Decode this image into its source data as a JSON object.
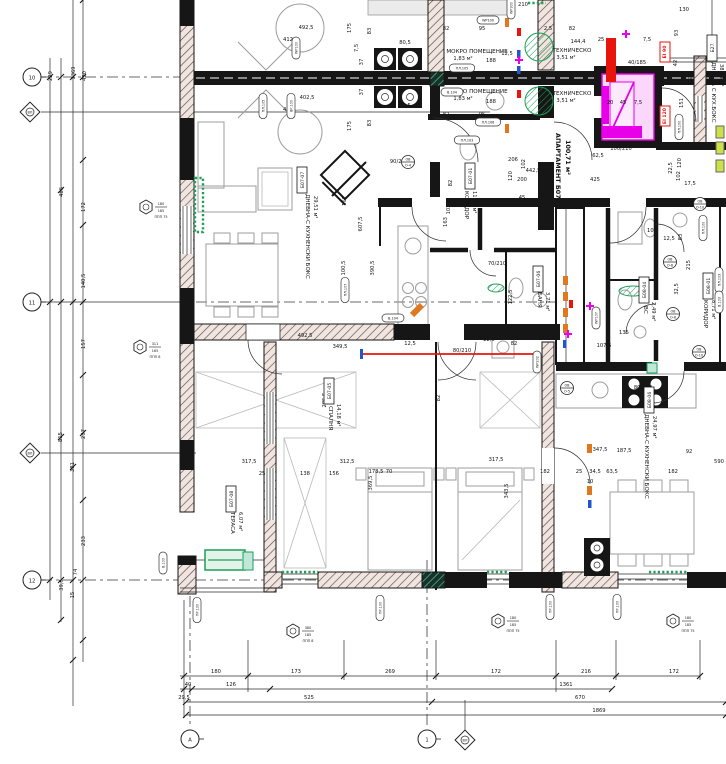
{
  "colors": {
    "wall": "#161616",
    "green": "#1d9e57",
    "teal_fill": "#bfe8d8",
    "magenta": "#e800e8",
    "pink": "#fbd7fb",
    "red": "#e8150d",
    "orange": "#e07820",
    "blue": "#2256cc",
    "wall_tint": "#f2e4de",
    "furniture": "#9d9d9d",
    "yellow_green": "#cde04a"
  },
  "rooms": [
    [
      "МОКРО ПОМЕЩЕНИЕ",
      477,
      53,
      0,
      "room"
    ],
    [
      "1,83 м²",
      463,
      60,
      0,
      "area"
    ],
    [
      "МОКРО ПОМЕЩЕНИЕ",
      477,
      93,
      0,
      "room"
    ],
    [
      "1,83 м²",
      463,
      100,
      0,
      "area"
    ],
    [
      "ТЕХНИЧЕСКО",
      572,
      52,
      0,
      "room"
    ],
    [
      "3,51 м²",
      566,
      59,
      0,
      "area"
    ],
    [
      "ТЕХНИЧЕСКО",
      572,
      95,
      0,
      "room"
    ],
    [
      "3,51 м²",
      566,
      102,
      0,
      "area"
    ],
    [
      "АПАРТАМЕНТ Б07",
      556,
      133,
      90,
      "apt"
    ],
    [
      "100,71 м²",
      566,
      140,
      90,
      "apt"
    ],
    [
      "ДНЕВНА-С КУХНЕНСКИ БОКС",
      306,
      194,
      90,
      "room"
    ],
    [
      "29,51 м²",
      314,
      196,
      90,
      "area"
    ],
    [
      "КОРИДОР",
      465,
      191,
      90,
      "room"
    ],
    [
      "11,93 м²",
      473,
      191,
      90,
      "area"
    ],
    [
      "БАНЯ",
      538,
      292,
      90,
      "room"
    ],
    [
      "3,71 м²",
      546,
      292,
      90,
      "area"
    ],
    [
      "ВС",
      644,
      306,
      90,
      "room"
    ],
    [
      "2,49 м²",
      652,
      302,
      90,
      "area"
    ],
    [
      "КОРИДОР",
      704,
      300,
      90,
      "room"
    ],
    [
      "8,71 м²",
      712,
      300,
      90,
      "area"
    ],
    [
      "СПАЛНЯ",
      329,
      406,
      90,
      "room"
    ],
    [
      "14,18 м²",
      337,
      404,
      90,
      "area"
    ],
    [
      "ТЕРАСА",
      231,
      512,
      90,
      "room"
    ],
    [
      "6,07 м²",
      239,
      512,
      90,
      "area"
    ],
    [
      "ДНЕВНА-С КУХНЕНСКИ БОКС",
      645,
      414,
      90,
      "room"
    ],
    [
      "24,97 м²",
      653,
      416,
      90,
      "area"
    ],
    [
      "ДНЕВНА С КУХ.БОКС",
      712,
      62,
      90,
      "room"
    ],
    [
      "38,73 м²",
      720,
      64,
      90,
      "area"
    ]
  ],
  "tagboxes": [
    [
      "Б07-07",
      302,
      180,
      -90
    ],
    [
      "Б07-01",
      470,
      176,
      -90
    ],
    [
      "Б07-05",
      329,
      391,
      -90
    ],
    [
      "Б07-06",
      538,
      279,
      -90
    ],
    [
      "Б07-08",
      231,
      499,
      -90
    ],
    [
      "Б08-01",
      708,
      286,
      -90
    ],
    [
      "Б08-04",
      644,
      290,
      -90
    ],
    [
      "Б08-06",
      649,
      400,
      -90
    ],
    [
      "Б27",
      712,
      48,
      -90
    ]
  ],
  "dims": [
    [
      "492,5",
      306,
      29,
      0
    ],
    [
      "412",
      288,
      41,
      0
    ],
    [
      "402,5",
      307,
      99,
      0
    ],
    [
      "412",
      288,
      111,
      0
    ],
    [
      "82",
      446,
      30,
      0
    ],
    [
      "95",
      482,
      30,
      0
    ],
    [
      "2,5",
      548,
      30,
      0
    ],
    [
      "82",
      572,
      30,
      0
    ],
    [
      "80,5",
      405,
      44,
      0
    ],
    [
      "188",
      491,
      62,
      0
    ],
    [
      "12,5",
      507,
      55,
      0
    ],
    [
      "144,4",
      578,
      43,
      0
    ],
    [
      "80,5",
      405,
      107,
      0
    ],
    [
      "188",
      491,
      103,
      0
    ],
    [
      "82",
      446,
      116,
      0
    ],
    [
      "95",
      482,
      116,
      0
    ],
    [
      "210",
      523,
      6,
      0
    ],
    [
      "130",
      684,
      11,
      0
    ],
    [
      "25",
      601,
      41,
      0
    ],
    [
      "7,5",
      647,
      41,
      0
    ],
    [
      "20",
      610,
      104,
      0
    ],
    [
      "45",
      623,
      104,
      0
    ],
    [
      "7,5",
      638,
      104,
      0
    ],
    [
      "93",
      678,
      33,
      -90
    ],
    [
      "42",
      677,
      63,
      -90
    ],
    [
      "296",
      692,
      78,
      -90
    ],
    [
      "151",
      683,
      103,
      -90
    ],
    [
      "120",
      681,
      163,
      -90
    ],
    [
      "102",
      680,
      176,
      -90
    ],
    [
      "17,5",
      690,
      185,
      0
    ],
    [
      "22,5",
      672,
      168,
      -90
    ],
    [
      "175",
      351,
      28,
      -90
    ],
    [
      "83",
      371,
      31,
      -90
    ],
    [
      "7,5",
      358,
      48,
      -90
    ],
    [
      "37",
      363,
      62,
      -90
    ],
    [
      "37",
      363,
      92,
      -90
    ],
    [
      "175",
      351,
      126,
      -90
    ],
    [
      "83",
      371,
      123,
      -90
    ],
    [
      "162",
      346,
      201,
      -90
    ],
    [
      "607,5",
      362,
      224,
      -90
    ],
    [
      "100,5",
      345,
      268,
      -90
    ],
    [
      "390,5",
      374,
      268,
      -90
    ],
    [
      "285,5",
      326,
      400,
      -90
    ],
    [
      "82",
      440,
      398,
      -90
    ],
    [
      "206",
      513,
      161,
      0
    ],
    [
      "102",
      525,
      164,
      -90
    ],
    [
      "442,5",
      533,
      172,
      0
    ],
    [
      "200",
      522,
      181,
      0
    ],
    [
      "120",
      512,
      176,
      -90
    ],
    [
      "45",
      522,
      199,
      0
    ],
    [
      "62,5",
      598,
      157,
      0
    ],
    [
      "425",
      595,
      181,
      0
    ],
    [
      "82",
      452,
      183,
      -90
    ],
    [
      "103,5",
      450,
      207,
      -90
    ],
    [
      "163",
      447,
      222,
      -90
    ],
    [
      "492,5",
      305,
      337,
      0
    ],
    [
      "349,5",
      340,
      348,
      0
    ],
    [
      "12,5",
      410,
      345,
      0
    ],
    [
      "82",
      514,
      345,
      0
    ],
    [
      "22,5",
      489,
      341,
      0
    ],
    [
      "122,5",
      512,
      297,
      -90
    ],
    [
      "135",
      624,
      334,
      0
    ],
    [
      "107,5",
      604,
      347,
      0
    ],
    [
      "37,5",
      622,
      366,
      0
    ],
    [
      "12,5",
      669,
      240,
      0
    ],
    [
      "102",
      652,
      232,
      0
    ],
    [
      "215",
      690,
      265,
      -90
    ],
    [
      "32,5",
      678,
      289,
      -90
    ],
    [
      "83",
      682,
      237,
      -90
    ],
    [
      "347,5",
      600,
      451,
      0
    ],
    [
      "187,5",
      624,
      452,
      0
    ],
    [
      "92",
      689,
      453,
      0
    ],
    [
      "317,5",
      249,
      463,
      0
    ],
    [
      "317,5",
      496,
      461,
      0
    ],
    [
      "312,5",
      347,
      463,
      0
    ],
    [
      "156",
      334,
      475,
      0
    ],
    [
      "138",
      305,
      475,
      0
    ],
    [
      "25",
      262,
      475,
      0
    ],
    [
      "178,5",
      376,
      473,
      0
    ],
    [
      "70",
      389,
      473,
      0
    ],
    [
      "182",
      545,
      473,
      0
    ],
    [
      "25",
      579,
      473,
      0
    ],
    [
      "34,5",
      595,
      473,
      0
    ],
    [
      "63,5",
      612,
      473,
      0
    ],
    [
      "182",
      673,
      473,
      0
    ],
    [
      "590",
      719,
      463,
      0
    ],
    [
      "343,5",
      508,
      491,
      -90
    ],
    [
      "369,5",
      372,
      483,
      -90
    ],
    [
      "10",
      590,
      483,
      0
    ],
    [
      "180",
      216,
      673,
      0
    ],
    [
      "173",
      296,
      673,
      0
    ],
    [
      "269",
      390,
      673,
      0
    ],
    [
      "172",
      496,
      673,
      0
    ],
    [
      "216",
      586,
      673,
      0
    ],
    [
      "172",
      674,
      673,
      0
    ],
    [
      "40",
      188,
      686,
      0
    ],
    [
      "126",
      231,
      686,
      0
    ],
    [
      "1361",
      566,
      686,
      0
    ],
    [
      "525",
      309,
      699,
      0
    ],
    [
      "670",
      580,
      699,
      0
    ],
    [
      "1869",
      599,
      712,
      0
    ],
    [
      "29,5",
      184,
      699,
      0
    ],
    [
      "229",
      52,
      76,
      -90
    ],
    [
      "1369",
      75,
      73,
      -90
    ],
    [
      "490",
      86,
      76,
      -90
    ],
    [
      "486",
      63,
      192,
      -90
    ],
    [
      "172",
      85,
      207,
      -90
    ],
    [
      "140,5",
      85,
      281,
      -90
    ],
    [
      "157",
      85,
      344,
      -90
    ],
    [
      "815",
      62,
      437,
      -90
    ],
    [
      "237",
      85,
      434,
      -90
    ],
    [
      "381",
      74,
      467,
      -90
    ],
    [
      "233",
      85,
      541,
      -90
    ],
    [
      "74",
      77,
      572,
      -90
    ],
    [
      "39,5",
      63,
      585,
      -90
    ],
    [
      "15",
      74,
      595,
      -90
    ]
  ],
  "doorlabels": [
    [
      "90/210",
      399,
      163
    ],
    [
      "100/210",
      621,
      150
    ],
    [
      "80/210",
      643,
      389
    ],
    [
      "40/185",
      637,
      64
    ],
    [
      "70/210",
      497,
      265
    ],
    [
      "80/210",
      462,
      352
    ]
  ],
  "ovals": [
    [
      "WP100",
      296,
      48,
      -90
    ],
    [
      "ПЛ.105",
      263,
      106,
      -90
    ],
    [
      "ВР.100",
      291,
      106,
      -90
    ],
    [
      "WP100",
      488,
      20,
      0
    ],
    [
      "ПЛ.105",
      462,
      68,
      0
    ],
    [
      "ПЛ.106",
      488,
      122,
      0
    ],
    [
      "В.104",
      452,
      92,
      0
    ],
    [
      "WP300",
      511,
      8,
      -90
    ],
    [
      "ПЛ.107",
      345,
      290,
      -90
    ],
    [
      "ПЛ.103",
      467,
      140,
      0
    ],
    [
      "В.104",
      393,
      318,
      0
    ],
    [
      "WP202",
      537,
      362,
      -90
    ],
    [
      "WP107",
      596,
      318,
      -90
    ],
    [
      "ПЛ.103",
      719,
      280,
      -90
    ],
    [
      "В.103",
      719,
      302,
      -90
    ],
    [
      "ПЛ.100",
      703,
      228,
      -90
    ],
    [
      "ПР.100",
      380,
      608,
      -90
    ],
    [
      "ПР.100",
      550,
      607,
      -90
    ],
    [
      "ПР.100",
      617,
      607,
      -90
    ],
    [
      "ПР.100",
      197,
      610,
      -90
    ],
    [
      "В.100",
      163,
      563,
      -90
    ],
    [
      "ПЛ.100",
      679,
      127,
      -90
    ]
  ],
  "hexes": [
    [
      146,
      207,
      "180",
      "185",
      "ППП 75"
    ],
    [
      140,
      347,
      "311",
      "165",
      "ППП 8"
    ],
    [
      293,
      631,
      "380",
      "185",
      "ППП 8"
    ],
    [
      498,
      621,
      "180",
      "185",
      "ППП 75"
    ],
    [
      673,
      621,
      "180",
      "185",
      "ППП 75"
    ]
  ],
  "axes": [
    [
      "circle",
      "10",
      32,
      77
    ],
    [
      "circle",
      "11",
      32,
      302
    ],
    [
      "circle",
      "12",
      32,
      580
    ],
    [
      "circle",
      "1",
      427,
      739
    ],
    [
      "circle",
      "А",
      190,
      739
    ],
    [
      "diamond",
      "ВЛ",
      30,
      112
    ],
    [
      "diamond",
      "ВЛ",
      30,
      453
    ],
    [
      "diamond",
      "ВЛ",
      465,
      740
    ]
  ],
  "eitags": [
    [
      "EI 90",
      665,
      52
    ],
    [
      "EI 120",
      665,
      116
    ]
  ],
  "ovcircles": [
    [
      "О-4",
      408,
      162
    ],
    [
      "О-5",
      567,
      388
    ],
    [
      "О-10",
      700,
      204
    ],
    [
      "О-8",
      670,
      262
    ],
    [
      "О-8",
      673,
      314
    ],
    [
      "О-10",
      699,
      352
    ]
  ]
}
